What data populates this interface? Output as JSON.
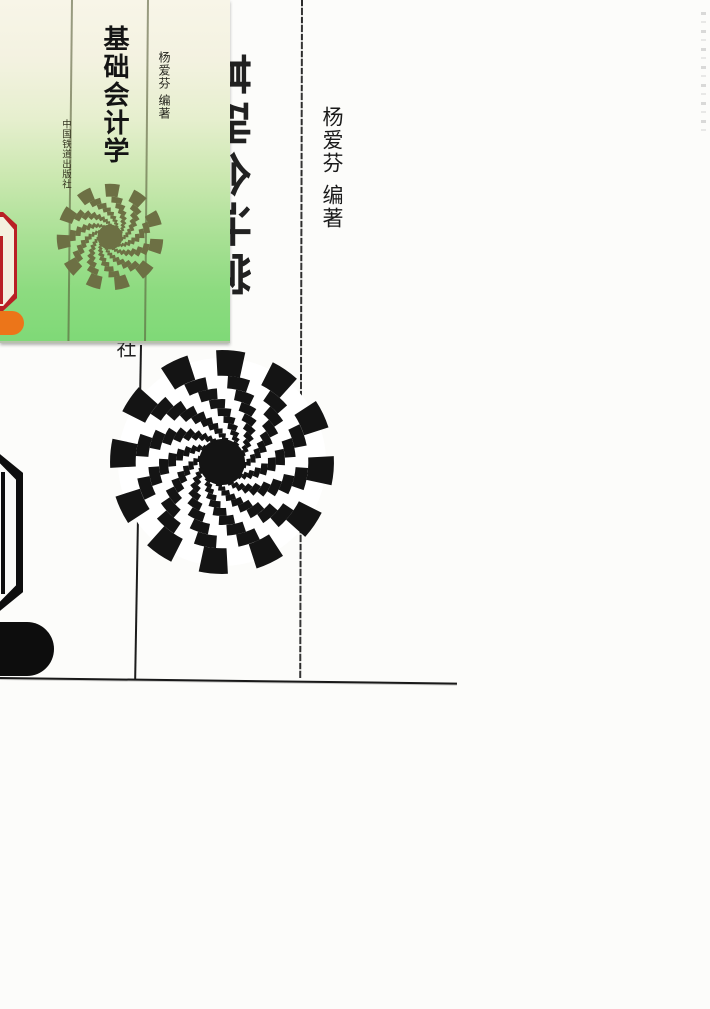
{
  "thumb": {
    "title": "基础会计学",
    "author": "杨爱芬",
    "author_role": "编著",
    "publisher": "中国铁道出版社"
  },
  "scan": {
    "big_title": "基础会计学",
    "author": "杨爱芬",
    "author_role": "编著",
    "publisher_remnant": "版社"
  },
  "colors": {
    "ink": "#141414",
    "olive_spiral": "#6d7044",
    "red_ring": "#b92025",
    "cream_inner": "#f4f0df",
    "orange_pill": "#ec7519",
    "green_cover_top": "#f8f5e8",
    "green_cover_bottom": "#7fd977"
  }
}
